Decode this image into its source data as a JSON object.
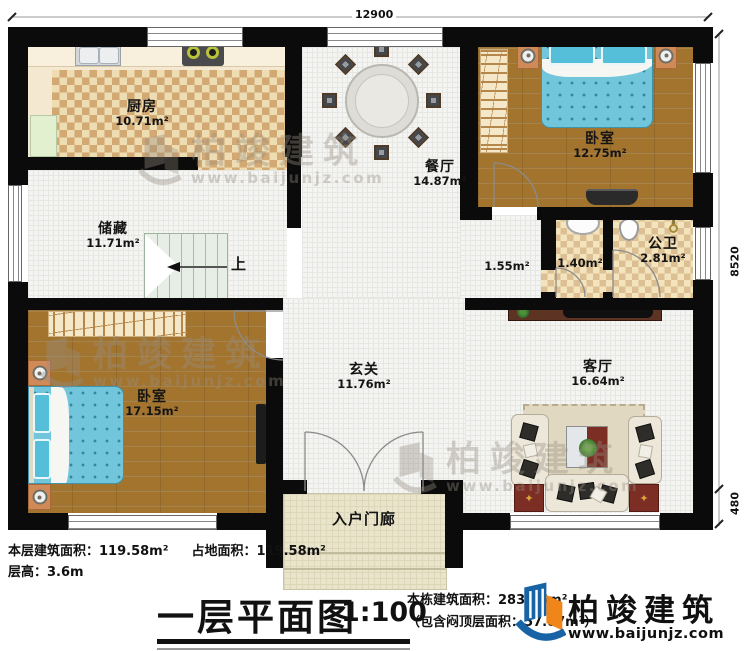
{
  "dims": {
    "top": "12900",
    "right": "8520",
    "porch": "480"
  },
  "stairs": {
    "up": "上"
  },
  "rooms": [
    {
      "id": "kitchen",
      "name": "厨房",
      "area": "10.71m²"
    },
    {
      "id": "dining",
      "name": "餐厅",
      "area": "14.87m²"
    },
    {
      "id": "bedroom-tr",
      "name": "卧室",
      "area": "12.75m²"
    },
    {
      "id": "bathroom",
      "name": "公卫",
      "area": "2.81m²"
    },
    {
      "id": "wash-area",
      "name": "",
      "area": "1.40m²"
    },
    {
      "id": "corridor",
      "name": "",
      "area": "1.55m²"
    },
    {
      "id": "storage",
      "name": "储藏",
      "area": "11.71m²"
    },
    {
      "id": "bedroom-bl",
      "name": "卧室",
      "area": "17.15m²"
    },
    {
      "id": "foyer",
      "name": "玄关",
      "area": "11.76m²"
    },
    {
      "id": "living",
      "name": "客厅",
      "area": "16.64m²"
    },
    {
      "id": "porch",
      "name": "入户门廊",
      "area": ""
    }
  ],
  "watermark": {
    "brand": "柏竣建筑",
    "site": "www.baijunjz.com"
  },
  "footer": {
    "floor_area": "本层建筑面积：119.58m²",
    "ground_area": "占地面积：119.58m²",
    "floor_height": "层高：3.6m",
    "title": "一层平面图",
    "scale": "1:100",
    "total_area": "本栋建筑面积：283.75m²",
    "attic_note": "（包含闷顶层面积：57.07m²）",
    "brand": "柏竣建筑",
    "site": "www.baijunjz.com"
  },
  "colors": {
    "brand_blue": "#1763a6",
    "brand_orange": "#f08519",
    "wall": "#0b0b0b",
    "bed_blue": "#72c6db"
  }
}
